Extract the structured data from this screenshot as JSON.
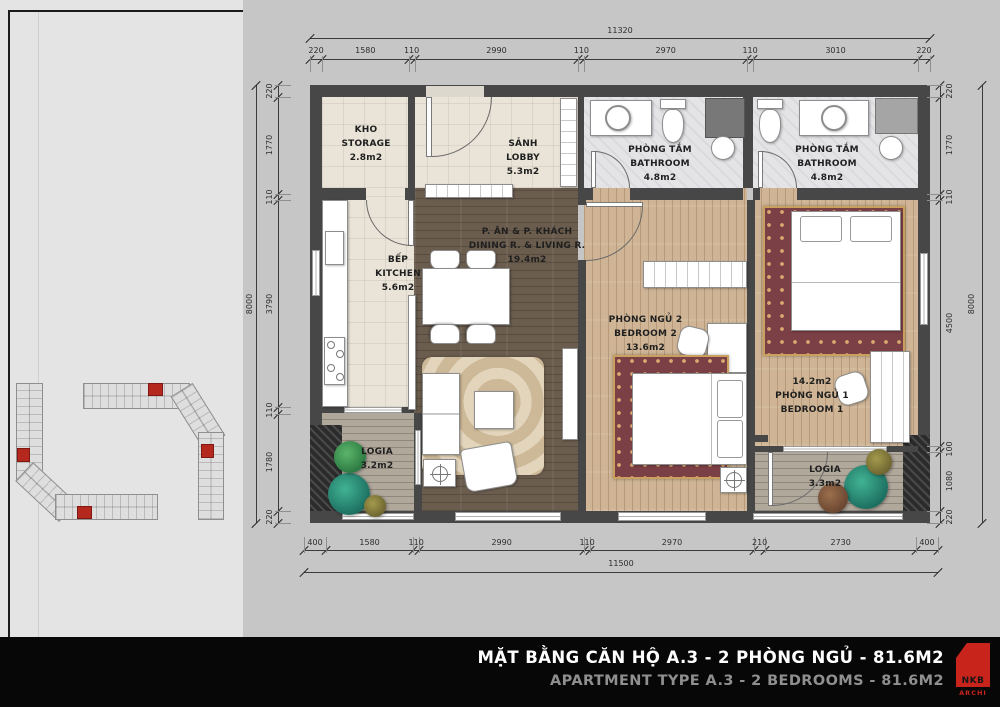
{
  "title_bar": {
    "title_vi": "MẶT BẰNG CĂN HỘ A.3 - 2 PHÒNG NGỦ - 81.6M2",
    "title_en": "APARTMENT TYPE A.3 - 2 BEDROOMS - 81.6M2",
    "logo_text": "NKB",
    "logo_sub": "ARCHI"
  },
  "colors": {
    "logo_red": "#c8241c",
    "unit_highlight_red": "#b5281e",
    "wall_gray": "#474747"
  },
  "dimensions": {
    "top": {
      "total": "11320",
      "segments": [
        "220",
        "1580",
        "110",
        "2990",
        "110",
        "2970",
        "110",
        "3010",
        "220"
      ]
    },
    "bottom": {
      "total": "11500",
      "segments": [
        "400",
        "1580",
        "110",
        "2990",
        "110",
        "2970",
        "210",
        "2730",
        "400"
      ]
    },
    "left": {
      "total": "8000",
      "segments": [
        "220",
        "1770",
        "110",
        "3790",
        "110",
        "1780",
        "220"
      ]
    },
    "right": {
      "total": "8000",
      "segments": [
        "220",
        "1770",
        "110",
        "4500",
        "100",
        "1080",
        "220"
      ]
    }
  },
  "rooms": {
    "storage": {
      "name_vi": "KHO",
      "name_en": "STORAGE",
      "area": "2.8m2"
    },
    "lobby": {
      "name_vi": "SẢNH",
      "name_en": "LOBBY",
      "area": "5.3m2"
    },
    "bathroom_1": {
      "name_vi": "PHÒNG TẮM",
      "name_en": "BATHROOM",
      "area": "4.8m2"
    },
    "bathroom_2": {
      "name_vi": "PHÒNG TẮM",
      "name_en": "BATHROOM",
      "area": "4.8m2"
    },
    "kitchen": {
      "name_vi": "BẾP",
      "name_en": "KITCHEN",
      "area": "5.6m2"
    },
    "dining_living": {
      "name_vi": "P. ĂN & P. KHÁCH",
      "name_en": "DINING R. & LIVING R.",
      "area": "19.4m2"
    },
    "bedroom_2": {
      "name_vi": "PHÒNG NGỦ 2",
      "name_en": "BEDROOM 2",
      "area": "13.6m2"
    },
    "bedroom_1": {
      "name_vi": "PHÒNG NGỦ 1",
      "name_en": "BEDROOM 1",
      "area": "14.2m2"
    },
    "logia_1": {
      "name_vi": "LOGIA",
      "area": "3.2m2"
    },
    "logia_2": {
      "name_vi": "LOGIA",
      "area": "3.3m2"
    }
  }
}
